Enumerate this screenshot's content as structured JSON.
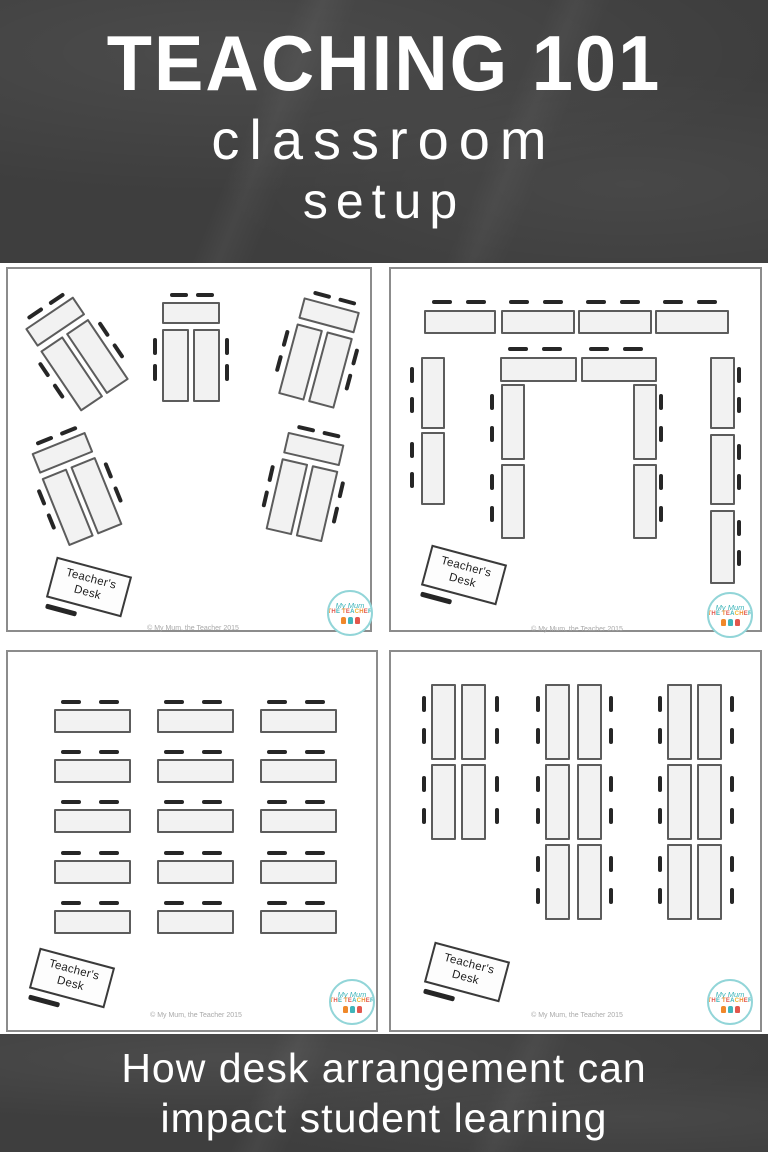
{
  "header": {
    "title": "TEACHING 101",
    "subtitle_top": "classroom",
    "subtitle_bottom": "setup"
  },
  "footer": {
    "line1": "How desk arrangement can",
    "line2": "impact student learning"
  },
  "branding": {
    "logo_top": "My Mum",
    "logo_bottom": "THE TEACHER",
    "copyright": "© My Mum, the Teacher 2015"
  },
  "teacher_desk": {
    "line1": "Teacher's",
    "line2": "Desk"
  },
  "colors": {
    "chalkboard": "#3e3e3e",
    "panel_background": "#ffffff",
    "panel_border": "#8c8c8c",
    "desk_fill": "#f2f2f2",
    "desk_border": "#5c5c5c",
    "chair_dash": "#262626",
    "title_text": "#ffffff",
    "logo_ring": "#92d5d8",
    "logo_teal": "#3fb5ba",
    "logo_orange": "#f0882a",
    "logo_red": "#e2574d",
    "logo_gold": "#f2b632",
    "copyright_text": "#a9a9a9"
  },
  "panels": [
    {
      "id": "angled-pods",
      "frame": [
        6,
        4,
        366,
        365
      ],
      "pod_template": {
        "w": 58,
        "h": 100,
        "desks": [
          [
            0,
            0,
            58,
            22
          ],
          [
            0,
            27,
            27,
            73
          ],
          [
            31,
            27,
            27,
            73
          ]
        ],
        "chairs": [
          [
            8,
            -9,
            18,
            4
          ],
          [
            34,
            -9,
            18,
            4
          ],
          [
            -9,
            36,
            4,
            17
          ],
          [
            -9,
            62,
            4,
            17
          ],
          [
            63,
            36,
            4,
            17
          ],
          [
            63,
            62,
            4,
            17
          ]
        ]
      },
      "pods": [
        {
          "cx": 69,
          "cy": 85,
          "rot": -34
        },
        {
          "cx": 183,
          "cy": 83,
          "rot": 0
        },
        {
          "cx": 311,
          "cy": 84,
          "rot": 15
        },
        {
          "cx": 69,
          "cy": 220,
          "rot": -22
        },
        {
          "cx": 297,
          "cy": 218,
          "rot": 13
        }
      ],
      "teacher_desk": {
        "cx": 81,
        "cy": 318,
        "rot": 15
      },
      "logo": {
        "cx": 342,
        "cy": 344
      },
      "copyright": {
        "cx": 185,
        "cy": 360
      }
    },
    {
      "id": "double-horseshoe",
      "frame": [
        389,
        4,
        373,
        365
      ],
      "desks": [
        [
          33,
          41,
          72,
          24
        ],
        [
          110,
          41,
          74,
          24
        ],
        [
          187,
          41,
          74,
          24
        ],
        [
          264,
          41,
          74,
          24
        ],
        [
          30,
          88,
          24,
          72
        ],
        [
          30,
          163,
          24,
          73
        ],
        [
          109,
          88,
          77,
          25
        ],
        [
          190,
          88,
          76,
          25
        ],
        [
          110,
          115,
          24,
          76
        ],
        [
          110,
          195,
          24,
          75
        ],
        [
          242,
          115,
          24,
          76
        ],
        [
          242,
          195,
          24,
          75
        ],
        [
          319,
          88,
          25,
          72
        ],
        [
          319,
          165,
          25,
          71
        ],
        [
          319,
          241,
          25,
          74
        ]
      ],
      "chairs": [
        [
          41,
          31,
          20,
          4
        ],
        [
          75,
          31,
          20,
          4
        ],
        [
          118,
          31,
          20,
          4
        ],
        [
          152,
          31,
          20,
          4
        ],
        [
          195,
          31,
          20,
          4
        ],
        [
          229,
          31,
          20,
          4
        ],
        [
          272,
          31,
          20,
          4
        ],
        [
          306,
          31,
          20,
          4
        ],
        [
          117,
          78,
          20,
          4
        ],
        [
          151,
          78,
          20,
          4
        ],
        [
          198,
          78,
          20,
          4
        ],
        [
          232,
          78,
          20,
          4
        ],
        [
          19,
          98,
          4,
          16
        ],
        [
          19,
          128,
          4,
          16
        ],
        [
          19,
          173,
          4,
          16
        ],
        [
          19,
          203,
          4,
          16
        ],
        [
          99,
          125,
          4,
          16
        ],
        [
          99,
          157,
          4,
          16
        ],
        [
          99,
          205,
          4,
          16
        ],
        [
          99,
          237,
          4,
          16
        ],
        [
          268,
          125,
          4,
          16
        ],
        [
          268,
          157,
          4,
          16
        ],
        [
          268,
          205,
          4,
          16
        ],
        [
          268,
          237,
          4,
          16
        ],
        [
          346,
          98,
          4,
          16
        ],
        [
          346,
          128,
          4,
          16
        ],
        [
          346,
          175,
          4,
          16
        ],
        [
          346,
          205,
          4,
          16
        ],
        [
          346,
          251,
          4,
          16
        ],
        [
          346,
          281,
          4,
          16
        ]
      ],
      "teacher_desk": {
        "cx": 73,
        "cy": 306,
        "rot": 15
      },
      "logo": {
        "cx": 339,
        "cy": 346
      },
      "copyright": {
        "cx": 186,
        "cy": 361
      }
    },
    {
      "id": "traditional-rows",
      "frame": [
        6,
        387,
        372,
        382
      ],
      "desks": [
        [
          46,
          57,
          77,
          24
        ],
        [
          149,
          57,
          77,
          24
        ],
        [
          252,
          57,
          77,
          24
        ],
        [
          46,
          107,
          77,
          24
        ],
        [
          149,
          107,
          77,
          24
        ],
        [
          252,
          107,
          77,
          24
        ],
        [
          46,
          157,
          77,
          24
        ],
        [
          149,
          157,
          77,
          24
        ],
        [
          252,
          157,
          77,
          24
        ],
        [
          46,
          208,
          77,
          24
        ],
        [
          149,
          208,
          77,
          24
        ],
        [
          252,
          208,
          77,
          24
        ],
        [
          46,
          258,
          77,
          24
        ],
        [
          149,
          258,
          77,
          24
        ],
        [
          252,
          258,
          77,
          24
        ]
      ],
      "chairs": [
        [
          53,
          48,
          20,
          4
        ],
        [
          91,
          48,
          20,
          4
        ],
        [
          156,
          48,
          20,
          4
        ],
        [
          194,
          48,
          20,
          4
        ],
        [
          259,
          48,
          20,
          4
        ],
        [
          297,
          48,
          20,
          4
        ],
        [
          53,
          98,
          20,
          4
        ],
        [
          91,
          98,
          20,
          4
        ],
        [
          156,
          98,
          20,
          4
        ],
        [
          194,
          98,
          20,
          4
        ],
        [
          259,
          98,
          20,
          4
        ],
        [
          297,
          98,
          20,
          4
        ],
        [
          53,
          148,
          20,
          4
        ],
        [
          91,
          148,
          20,
          4
        ],
        [
          156,
          148,
          20,
          4
        ],
        [
          194,
          148,
          20,
          4
        ],
        [
          259,
          148,
          20,
          4
        ],
        [
          297,
          148,
          20,
          4
        ],
        [
          53,
          199,
          20,
          4
        ],
        [
          91,
          199,
          20,
          4
        ],
        [
          156,
          199,
          20,
          4
        ],
        [
          194,
          199,
          20,
          4
        ],
        [
          259,
          199,
          20,
          4
        ],
        [
          297,
          199,
          20,
          4
        ],
        [
          53,
          249,
          20,
          4
        ],
        [
          91,
          249,
          20,
          4
        ],
        [
          156,
          249,
          20,
          4
        ],
        [
          194,
          249,
          20,
          4
        ],
        [
          259,
          249,
          20,
          4
        ],
        [
          297,
          249,
          20,
          4
        ]
      ],
      "teacher_desk": {
        "cx": 64,
        "cy": 326,
        "rot": 15
      },
      "logo": {
        "cx": 344,
        "cy": 350
      },
      "copyright": {
        "cx": 188,
        "cy": 364
      }
    },
    {
      "id": "paired-columns",
      "frame": [
        389,
        387,
        373,
        382
      ],
      "desks": [
        [
          40,
          32,
          25,
          76
        ],
        [
          70,
          32,
          25,
          76
        ],
        [
          40,
          112,
          25,
          76
        ],
        [
          70,
          112,
          25,
          76
        ],
        [
          154,
          32,
          25,
          76
        ],
        [
          186,
          32,
          25,
          76
        ],
        [
          154,
          112,
          25,
          76
        ],
        [
          186,
          112,
          25,
          76
        ],
        [
          154,
          192,
          25,
          76
        ],
        [
          186,
          192,
          25,
          76
        ],
        [
          276,
          32,
          25,
          76
        ],
        [
          306,
          32,
          25,
          76
        ],
        [
          276,
          112,
          25,
          76
        ],
        [
          306,
          112,
          25,
          76
        ],
        [
          276,
          192,
          25,
          76
        ],
        [
          306,
          192,
          25,
          76
        ]
      ],
      "chairs": [
        [
          31,
          44,
          4,
          16
        ],
        [
          31,
          76,
          4,
          16
        ],
        [
          31,
          124,
          4,
          16
        ],
        [
          31,
          156,
          4,
          16
        ],
        [
          104,
          44,
          4,
          16
        ],
        [
          104,
          76,
          4,
          16
        ],
        [
          104,
          124,
          4,
          16
        ],
        [
          104,
          156,
          4,
          16
        ],
        [
          145,
          44,
          4,
          16
        ],
        [
          145,
          76,
          4,
          16
        ],
        [
          145,
          124,
          4,
          16
        ],
        [
          145,
          156,
          4,
          16
        ],
        [
          145,
          204,
          4,
          16
        ],
        [
          145,
          236,
          4,
          16
        ],
        [
          218,
          44,
          4,
          16
        ],
        [
          218,
          76,
          4,
          16
        ],
        [
          218,
          124,
          4,
          16
        ],
        [
          218,
          156,
          4,
          16
        ],
        [
          218,
          204,
          4,
          16
        ],
        [
          218,
          236,
          4,
          16
        ],
        [
          267,
          44,
          4,
          16
        ],
        [
          267,
          76,
          4,
          16
        ],
        [
          267,
          124,
          4,
          16
        ],
        [
          267,
          156,
          4,
          16
        ],
        [
          267,
          204,
          4,
          16
        ],
        [
          267,
          236,
          4,
          16
        ],
        [
          339,
          44,
          4,
          16
        ],
        [
          339,
          76,
          4,
          16
        ],
        [
          339,
          124,
          4,
          16
        ],
        [
          339,
          156,
          4,
          16
        ],
        [
          339,
          204,
          4,
          16
        ],
        [
          339,
          236,
          4,
          16
        ]
      ],
      "teacher_desk": {
        "cx": 76,
        "cy": 320,
        "rot": 15
      },
      "logo": {
        "cx": 339,
        "cy": 350
      },
      "copyright": {
        "cx": 186,
        "cy": 364
      }
    }
  ]
}
